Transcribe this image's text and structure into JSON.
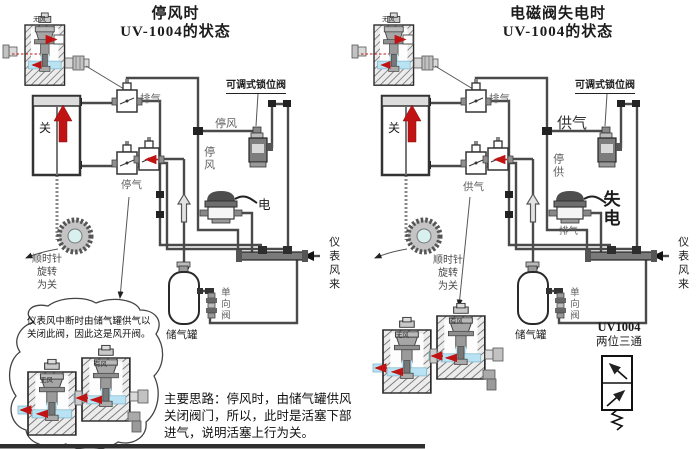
{
  "left": {
    "title1": "停风时",
    "title2": "UV-1004的状态",
    "cutaway_tag": "无风",
    "exhaust_valve": "排气",
    "stop_wind_line": "停风",
    "stop_wind_vert": "停风",
    "stop_air": "停气",
    "lock_valve": "可调式锁位阀",
    "power": "电",
    "cyl_state": "关",
    "wheel1": "顺时针",
    "wheel2": "旋转",
    "wheel3": "为关",
    "tank": "储气罐",
    "check_valve": "单向阀",
    "instr_air": "仪表风来",
    "bubble_note": "仪表风中断时由储气罐供气以关闭此阀，因此这是风开阀。",
    "bubble_tag_l": "无风",
    "bubble_tag_r": "有风",
    "footnote": "主要思路：停风时，由储气罐供风关闭阀门，所以，此时是活塞下部进气，说明活塞上行为关。"
  },
  "right": {
    "title1": "电磁阀失电时",
    "title2": "UV-1004的状态",
    "cutaway_tag": "无风",
    "exhaust_valve": "排气",
    "supply_line": "供气",
    "stop_supply_vert": "停供",
    "supply_air": "供气",
    "lock_valve": "可调式锁位阀",
    "power_loss": "失电",
    "solenoid_exhaust": "排气",
    "cyl_state": "关",
    "wheel1": "顺时针",
    "wheel2": "旋转",
    "wheel3": "为关",
    "tank": "储气罐",
    "check_valve": "单向阀",
    "instr_air": "仪表风来",
    "pair_tag_l": "无风",
    "pair_tag_r": "有风",
    "uv_model": "UV1004",
    "uv_type": "两位三通"
  },
  "colors": {
    "pipe": "#4a4a4a",
    "flow_arrow": "#c01414",
    "air_channel": "#b9e2f2",
    "hatch": "#777777"
  }
}
